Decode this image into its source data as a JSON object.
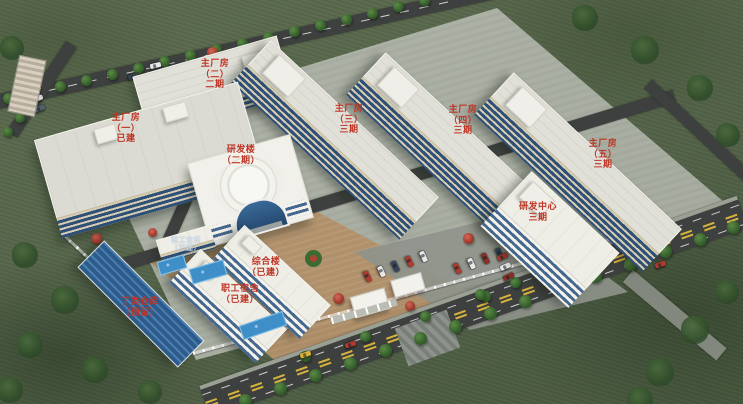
{
  "scene": {
    "kind": "aerial-campus-masterplan-rendering"
  },
  "colors": {
    "label_red": "#bf3526",
    "roof_light": "#e1e0d8",
    "wall_cream": "#d6cdb2",
    "window_blue": "#2e5078",
    "warehouse_blue": "#38679b",
    "grass_green": "#56664b",
    "road_gray": "#3d403e",
    "ground_tan": "#b2906a",
    "fence_white": "#ffffff",
    "pool_blue": "#3e8ec8"
  },
  "labels": {
    "factory1": {
      "lines": [
        "主厂房",
        "（一）",
        "已建"
      ]
    },
    "factory2": {
      "lines": [
        "主厂房",
        "（二）",
        "二期"
      ]
    },
    "factory3": {
      "lines": [
        "主厂房",
        "（三）",
        "三期"
      ]
    },
    "factory4": {
      "lines": [
        "主厂房",
        "（四）",
        "三期"
      ]
    },
    "factory5": {
      "lines": [
        "主厂房",
        "（五）",
        "三期"
      ]
    },
    "rd_building": {
      "lines": [
        "研发楼",
        "（二期）"
      ]
    },
    "rd_center": {
      "lines": [
        "研发中心",
        "三期"
      ]
    },
    "complex_building": {
      "lines": [
        "综合楼",
        "（已建）"
      ]
    },
    "staff_dormitory": {
      "lines": [
        "职工宿舍",
        "（已建）"
      ]
    },
    "class_d_warehouse": {
      "lines": [
        "丁类仓库",
        "（预留）"
      ]
    },
    "staff_canteen": {
      "lines": [
        "职工食堂",
        "（已建）"
      ]
    }
  }
}
